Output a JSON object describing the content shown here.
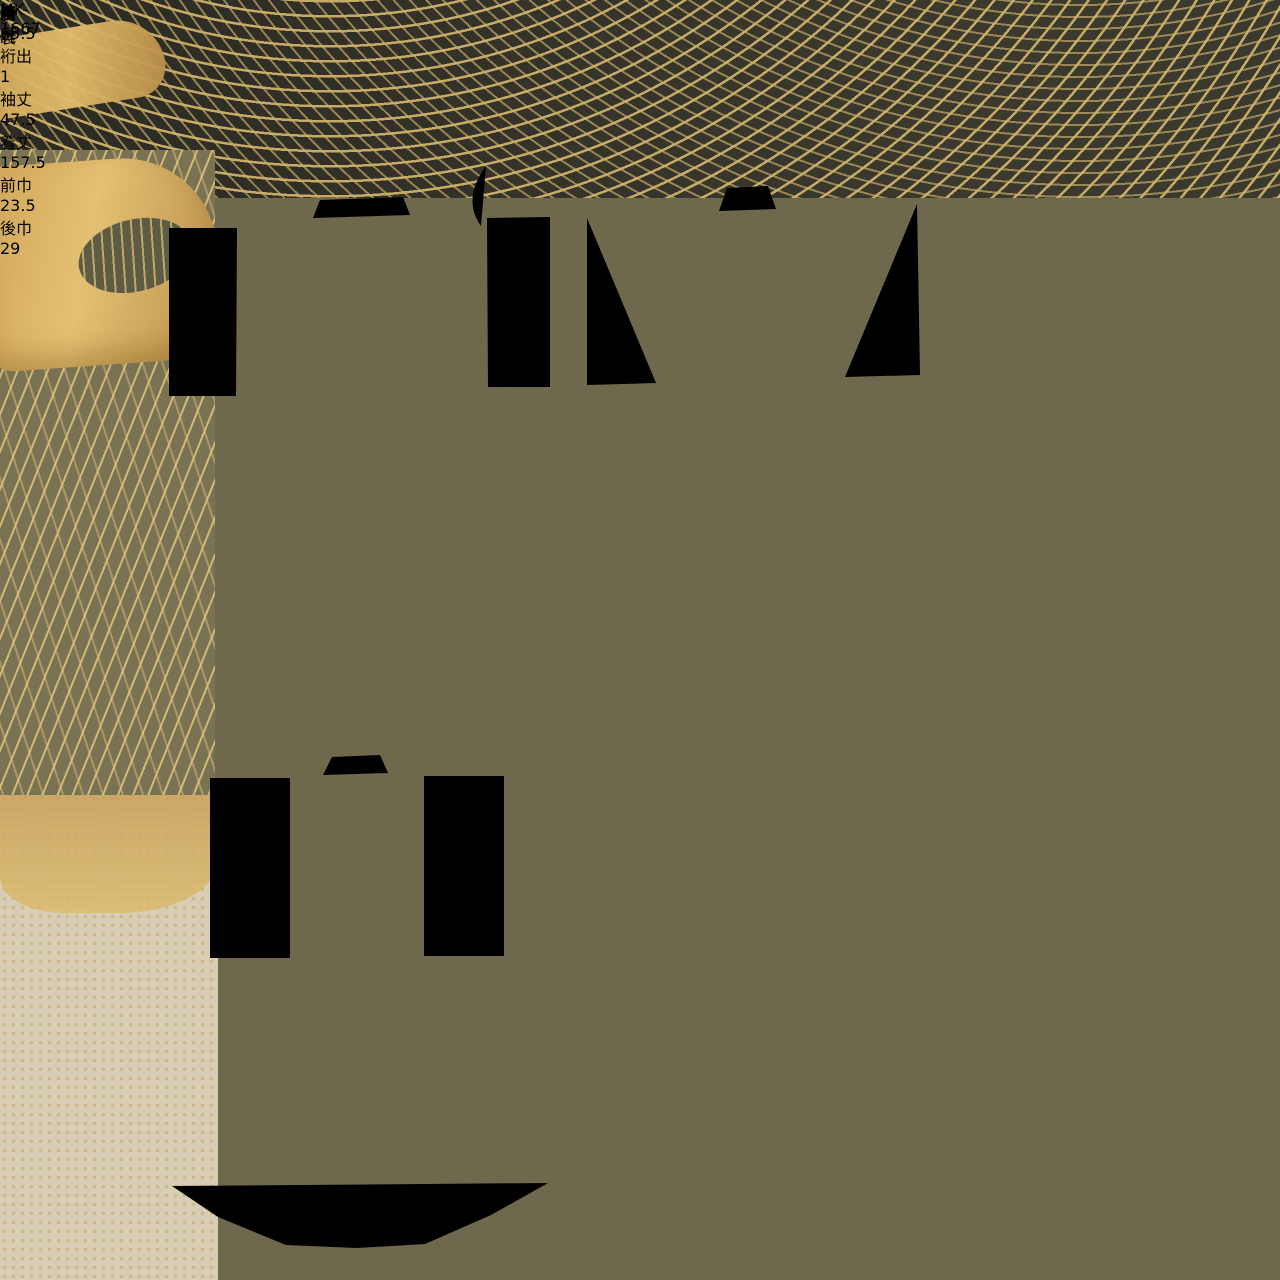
{
  "document": {
    "id_code": "MK-1667",
    "front_label": "表",
    "back_label": "裏",
    "lining_label": "胴裏",
    "annotations": {
      "stain_note": "汚れ",
      "stain_mark": "×",
      "lining_mark": "×"
    },
    "measurements": {
      "bullet": "•",
      "items": [
        {
          "label": "裄",
          "value": "65.5",
          "main": "65.",
          "sup": "5"
        },
        {
          "label": "裄出",
          "value": "1",
          "main": "1",
          "sup": ""
        },
        {
          "label": "袖丈",
          "value": "47.5",
          "main": "47.",
          "sup": "5"
        },
        {
          "label": "着丈",
          "value": "157.5",
          "main": "157.",
          "sup": "5"
        },
        {
          "label": "前巾",
          "value": "23.5",
          "main": "23.",
          "sup": "5"
        },
        {
          "label": "後巾",
          "value": "29",
          "main": "29",
          "sup": ""
        }
      ]
    }
  },
  "colors": {
    "paper": "#e9e8ed",
    "ink_handwriting": "#2d2d36",
    "ink_print": "#171717",
    "diagram_line": "#1f1f1f",
    "fabric_dark_olive": "#33322a",
    "fabric_olive": "#7a7353",
    "fabric_gold": "#d9b464",
    "fabric_cream": "#d8ceb5",
    "fabric_brown": "#7d5a4a",
    "flower_orange": "#b35427",
    "flower_white": "#efe7d9",
    "leaf_green": "#4c4a30"
  }
}
